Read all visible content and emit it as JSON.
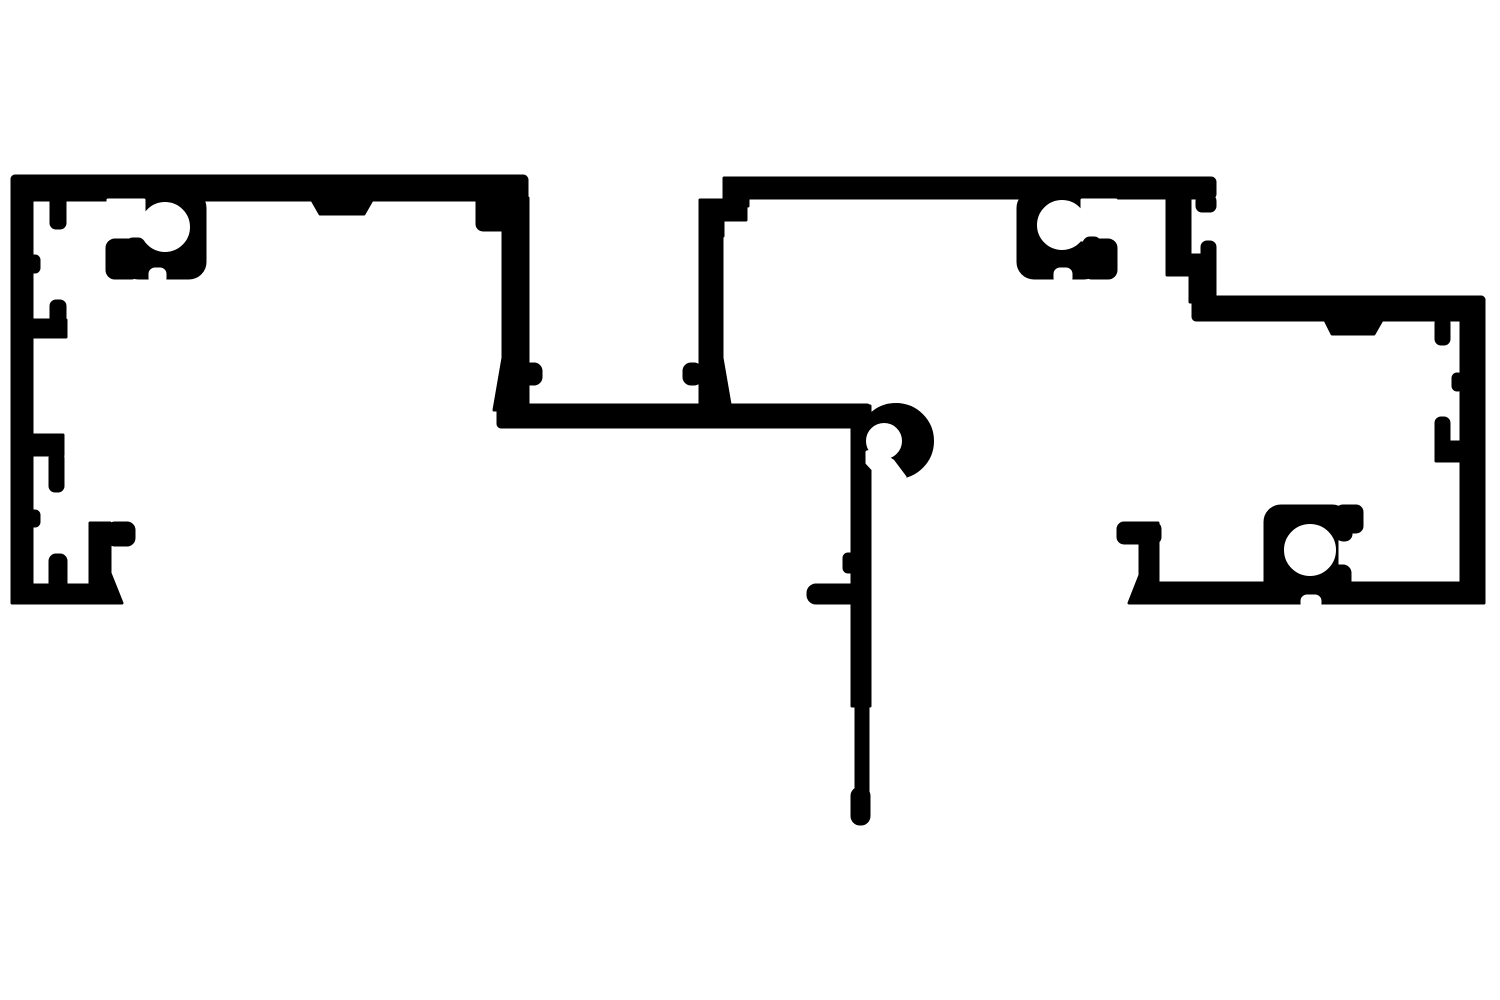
{
  "diagram": {
    "kind": "extrusion-profile-cross-section",
    "canvas": {
      "width": 1500,
      "height": 1000
    },
    "colors": {
      "foreground": "#000000",
      "background": "#ffffff"
    },
    "shapes": [
      {
        "name": "canvas-background",
        "kind": "rect",
        "fill": "bg",
        "x": 0,
        "y": 0,
        "w": 1500,
        "h": 1000
      },
      {
        "name": "top-bar-left-section",
        "kind": "rect",
        "fill": "fg",
        "x": 12,
        "y": 176,
        "w": 515,
        "h": 24,
        "rx": 4
      },
      {
        "name": "left-section-right-head",
        "kind": "rect",
        "fill": "fg",
        "x": 477,
        "y": 176,
        "w": 50,
        "h": 54,
        "rx": 6
      },
      {
        "name": "left-section-right-wall",
        "kind": "rect",
        "fill": "fg",
        "x": 503,
        "y": 198,
        "w": 25,
        "h": 212
      },
      {
        "name": "left-section-right-wall-flare",
        "kind": "polygon",
        "fill": "fg",
        "points": "494,410 504,352 504,410"
      },
      {
        "name": "left-section-right-wall-tooth",
        "kind": "rect",
        "fill": "fg",
        "x": 524,
        "y": 364,
        "w": 17,
        "h": 20,
        "rx": 7
      },
      {
        "name": "left-outer-wall",
        "kind": "rect",
        "fill": "fg",
        "x": 12,
        "y": 176,
        "w": 20,
        "h": 427,
        "rx": 3
      },
      {
        "name": "left-foot-bar",
        "kind": "rect",
        "fill": "fg",
        "x": 12,
        "y": 585,
        "w": 98,
        "h": 18
      },
      {
        "name": "left-foot-chamfer",
        "kind": "polygon",
        "fill": "fg",
        "points": "110,573 122,603 104,603"
      },
      {
        "name": "left-foot-finger-up",
        "kind": "rect",
        "fill": "fg",
        "x": 50,
        "y": 555,
        "w": 16,
        "h": 40,
        "rx": 6
      },
      {
        "name": "left-foot-tab-vertical",
        "kind": "rect",
        "fill": "fg",
        "x": 90,
        "y": 523,
        "w": 20,
        "h": 70
      },
      {
        "name": "left-foot-tab-stub",
        "kind": "rect",
        "fill": "fg",
        "x": 108,
        "y": 523,
        "w": 26,
        "h": 22,
        "rx": 7
      },
      {
        "name": "left-wall-hanging-tab",
        "kind": "rect",
        "fill": "fg",
        "x": 51,
        "y": 196,
        "w": 14,
        "h": 32,
        "rx": 5
      },
      {
        "name": "left-wall-bump-upper",
        "kind": "rect",
        "fill": "fg",
        "x": 30,
        "y": 256,
        "w": 9,
        "h": 16,
        "rx": 4
      },
      {
        "name": "left-wall-up-hook-finger",
        "kind": "rect",
        "fill": "fg",
        "x": 51,
        "y": 301,
        "w": 14,
        "h": 36,
        "rx": 5
      },
      {
        "name": "left-wall-up-hook-web",
        "kind": "rect",
        "fill": "fg",
        "x": 30,
        "y": 320,
        "w": 36,
        "h": 17
      },
      {
        "name": "left-wall-down-hook-web",
        "kind": "rect",
        "fill": "fg",
        "x": 30,
        "y": 435,
        "w": 33,
        "h": 20
      },
      {
        "name": "left-wall-down-hook-finger",
        "kind": "rect",
        "fill": "fg",
        "x": 50,
        "y": 453,
        "w": 13,
        "h": 38,
        "rx": 5
      },
      {
        "name": "left-wall-bump-lower",
        "kind": "rect",
        "fill": "fg",
        "x": 30,
        "y": 511,
        "w": 9,
        "h": 15,
        "rx": 4
      },
      {
        "name": "top-bar-left-tab",
        "kind": "polygon",
        "fill": "fg",
        "points": "312,200 372,200 364,214 320,214"
      },
      {
        "name": "screw-boss-left-body",
        "kind": "rect",
        "fill": "fg",
        "x": 123,
        "y": 192,
        "w": 82,
        "h": 86,
        "rx": 16
      },
      {
        "name": "bottom-bar-middle",
        "kind": "rect",
        "fill": "fg",
        "x": 498,
        "y": 405,
        "w": 372,
        "h": 22,
        "rx": 3
      },
      {
        "name": "mid-section-left-wall",
        "kind": "rect",
        "fill": "fg",
        "x": 700,
        "y": 226,
        "w": 22,
        "h": 184
      },
      {
        "name": "mid-section-left-wall-flare",
        "kind": "polygon",
        "fill": "fg",
        "points": "721,410 721,352 731,410"
      },
      {
        "name": "mid-section-left-wall-tooth",
        "kind": "rect",
        "fill": "fg",
        "x": 684,
        "y": 364,
        "w": 17,
        "h": 20,
        "rx": 7
      },
      {
        "name": "mid-section-left-head-a",
        "kind": "rect",
        "fill": "fg",
        "x": 700,
        "y": 200,
        "w": 46,
        "h": 20
      },
      {
        "name": "mid-section-left-head-b",
        "kind": "rect",
        "fill": "fg",
        "x": 700,
        "y": 218,
        "w": 23,
        "h": 18
      },
      {
        "name": "mid-section-head-connector",
        "kind": "rect",
        "fill": "fg",
        "x": 724,
        "y": 178,
        "w": 24,
        "h": 28
      },
      {
        "name": "top-bar-mid-section",
        "kind": "rect",
        "fill": "fg",
        "x": 728,
        "y": 178,
        "w": 487,
        "h": 20,
        "rx": 4
      },
      {
        "name": "screw-boss-mid-body",
        "kind": "rect",
        "fill": "fg",
        "x": 1018,
        "y": 192,
        "w": 82,
        "h": 86,
        "rx": 16
      },
      {
        "name": "mid-section-right-wall",
        "kind": "rect",
        "fill": "fg",
        "x": 1167,
        "y": 178,
        "w": 23,
        "h": 97
      },
      {
        "name": "top-bar-end-lip",
        "kind": "rect",
        "fill": "fg",
        "x": 1197,
        "y": 196,
        "w": 18,
        "h": 15,
        "rx": 5
      },
      {
        "name": "step-stub",
        "kind": "rect",
        "fill": "fg",
        "x": 1202,
        "y": 242,
        "w": 13,
        "h": 22,
        "rx": 5
      },
      {
        "name": "step-block",
        "kind": "rect",
        "fill": "fg",
        "x": 1190,
        "y": 255,
        "w": 25,
        "h": 47
      },
      {
        "name": "top-bar-right-section",
        "kind": "rect",
        "fill": "fg",
        "x": 1193,
        "y": 297,
        "w": 291,
        "h": 23,
        "rx": 3
      },
      {
        "name": "right-outer-wall",
        "kind": "rect",
        "fill": "fg",
        "x": 1461,
        "y": 297,
        "w": 23,
        "h": 306,
        "rx": 3
      },
      {
        "name": "bottom-bar-right-section",
        "kind": "rect",
        "fill": "fg",
        "x": 1152,
        "y": 583,
        "w": 332,
        "h": 20
      },
      {
        "name": "right-foot-stub",
        "kind": "rect",
        "fill": "fg",
        "x": 1118,
        "y": 523,
        "w": 42,
        "h": 20,
        "rx": 6
      },
      {
        "name": "right-foot-vertical",
        "kind": "rect",
        "fill": "fg",
        "x": 1140,
        "y": 523,
        "w": 18,
        "h": 80
      },
      {
        "name": "right-foot-chamfer",
        "kind": "polygon",
        "fill": "fg",
        "points": "1140,575 1129,603 1152,603"
      },
      {
        "name": "top-bar-right-tab",
        "kind": "polygon",
        "fill": "fg",
        "points": "1325,320 1382,320 1374,334 1332,334"
      },
      {
        "name": "right-hanging-finger",
        "kind": "rect",
        "fill": "fg",
        "x": 1436,
        "y": 318,
        "w": 13,
        "h": 26,
        "rx": 5
      },
      {
        "name": "right-wall-bump",
        "kind": "rect",
        "fill": "fg",
        "x": 1453,
        "y": 374,
        "w": 9,
        "h": 16,
        "rx": 4
      },
      {
        "name": "right-channel-finger",
        "kind": "rect",
        "fill": "fg",
        "x": 1436,
        "y": 418,
        "w": 13,
        "h": 30,
        "rx": 5
      },
      {
        "name": "right-channel-web",
        "kind": "rect",
        "fill": "fg",
        "x": 1436,
        "y": 442,
        "w": 26,
        "h": 19
      },
      {
        "name": "screw-boss-right-body",
        "kind": "rect",
        "fill": "fg",
        "x": 1265,
        "y": 506,
        "w": 83,
        "h": 97,
        "rx": 16
      },
      {
        "name": "hook-curl",
        "kind": "circle",
        "fill": "fg",
        "cx": 896,
        "cy": 441,
        "r": 37
      },
      {
        "name": "stem-upper",
        "kind": "rect",
        "fill": "fg",
        "x": 852,
        "y": 406,
        "w": 18,
        "h": 300
      },
      {
        "name": "stem-side-bump",
        "kind": "rect",
        "fill": "fg",
        "x": 844,
        "y": 554,
        "w": 10,
        "h": 18,
        "rx": 4
      },
      {
        "name": "stem-arm",
        "kind": "rect",
        "fill": "fg",
        "x": 808,
        "y": 585,
        "w": 58,
        "h": 18,
        "rx": 8
      },
      {
        "name": "stem-lower",
        "kind": "rect",
        "fill": "fg",
        "x": 856,
        "y": 700,
        "w": 12,
        "h": 96
      },
      {
        "name": "stem-tip",
        "kind": "rect",
        "fill": "fg",
        "x": 852,
        "y": 788,
        "w": 17,
        "h": 36,
        "rx": 8
      },
      {
        "name": "boss-left-slot",
        "kind": "rect",
        "fill": "bg",
        "x": 108,
        "y": 200,
        "w": 36,
        "h": 40
      },
      {
        "name": "boss-left-hole",
        "kind": "circle",
        "fill": "bg",
        "cx": 165,
        "cy": 227,
        "r": 24
      },
      {
        "name": "boss-left-notch",
        "kind": "rect",
        "fill": "bg",
        "x": 150,
        "y": 269,
        "w": 15,
        "h": 14,
        "rx": 5
      },
      {
        "name": "boss-mid-slot",
        "kind": "rect",
        "fill": "bg",
        "x": 1082,
        "y": 200,
        "w": 34,
        "h": 40
      },
      {
        "name": "boss-mid-hole",
        "kind": "circle",
        "fill": "bg",
        "cx": 1062,
        "cy": 225,
        "r": 24
      },
      {
        "name": "boss-mid-notch",
        "kind": "rect",
        "fill": "bg",
        "x": 1055,
        "y": 269,
        "w": 16,
        "h": 14,
        "rx": 5
      },
      {
        "name": "boss-right-slot",
        "kind": "rect",
        "fill": "bg",
        "x": 1340,
        "y": 526,
        "w": 32,
        "h": 44
      },
      {
        "name": "boss-right-hole",
        "kind": "circle",
        "fill": "bg",
        "cx": 1310,
        "cy": 550,
        "r": 25
      },
      {
        "name": "bottom-bar-right-notch",
        "kind": "rect",
        "fill": "bg",
        "x": 1302,
        "y": 596,
        "w": 18,
        "h": 12,
        "rx": 5
      },
      {
        "name": "hook-hole",
        "kind": "circle",
        "fill": "bg",
        "cx": 884,
        "cy": 441,
        "r": 17
      },
      {
        "name": "hook-slot",
        "kind": "polygon",
        "fill": "bg",
        "points": "876,450 893,461 905,477 891,489 867,463 867,452"
      },
      {
        "name": "boss-left-lip",
        "kind": "rect",
        "fill": "fg",
        "x": 107,
        "y": 240,
        "w": 32,
        "h": 38,
        "rx": 8
      },
      {
        "name": "boss-left-nub",
        "kind": "rect",
        "fill": "fg",
        "x": 127,
        "y": 239,
        "w": 17,
        "h": 16,
        "rx": 6
      },
      {
        "name": "boss-mid-lip",
        "kind": "rect",
        "fill": "fg",
        "x": 1084,
        "y": 240,
        "w": 32,
        "h": 38,
        "rx": 8
      },
      {
        "name": "boss-mid-nub",
        "kind": "rect",
        "fill": "fg",
        "x": 1084,
        "y": 238,
        "w": 16,
        "h": 16,
        "rx": 6
      },
      {
        "name": "boss-right-lip",
        "kind": "rect",
        "fill": "fg",
        "x": 1337,
        "y": 506,
        "w": 25,
        "h": 26,
        "rx": 6
      },
      {
        "name": "boss-right-nub",
        "kind": "rect",
        "fill": "fg",
        "x": 1337,
        "y": 520,
        "w": 14,
        "h": 20,
        "rx": 6
      },
      {
        "name": "boss-right-lowblock",
        "kind": "rect",
        "fill": "fg",
        "x": 1330,
        "y": 566,
        "w": 20,
        "h": 37,
        "rx": 7
      }
    ]
  }
}
